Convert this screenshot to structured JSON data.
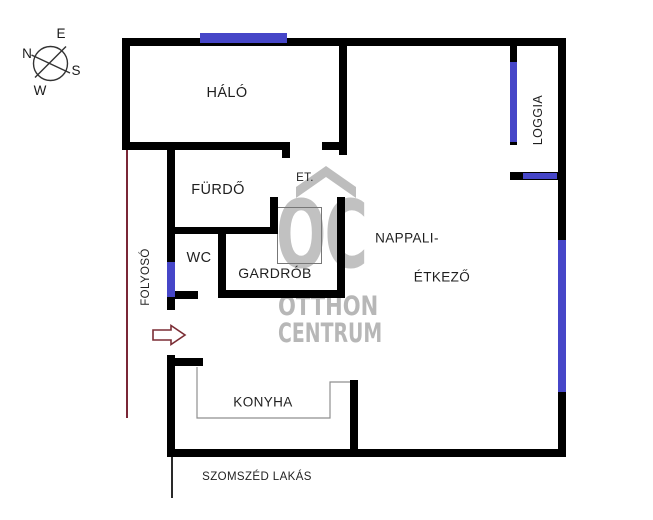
{
  "compass": {
    "n": "N",
    "e": "E",
    "s": "S",
    "w": "W"
  },
  "rooms": {
    "halo": {
      "label": "HÁLÓ"
    },
    "furdo": {
      "label": "FÜRDŐ"
    },
    "et": {
      "label": "ET."
    },
    "wc": {
      "label": "WC"
    },
    "gardrob": {
      "label": "GARDRÓB"
    },
    "nappali": {
      "label_line1": "NAPPALI-",
      "label_line2": "ÉTKEZŐ"
    },
    "konyha": {
      "label": "KONYHA"
    },
    "loggia": {
      "label": "LOGGIA"
    },
    "folyoso": {
      "label": "FOLYOSÓ"
    }
  },
  "annotations": {
    "neighbor_apartment": "SZOMSZÉD LAKÁS"
  },
  "watermark": {
    "logo": "OC",
    "line1": "OTTHON",
    "line2": "CENTRUM"
  },
  "colors": {
    "wall": "#000000",
    "window": "#4646c8",
    "accent": "#7a2636",
    "arrow": "#7b2d35",
    "watermark": "#bdbdbd",
    "text": "#1f1f1f",
    "thin": "#8f8f8f"
  }
}
